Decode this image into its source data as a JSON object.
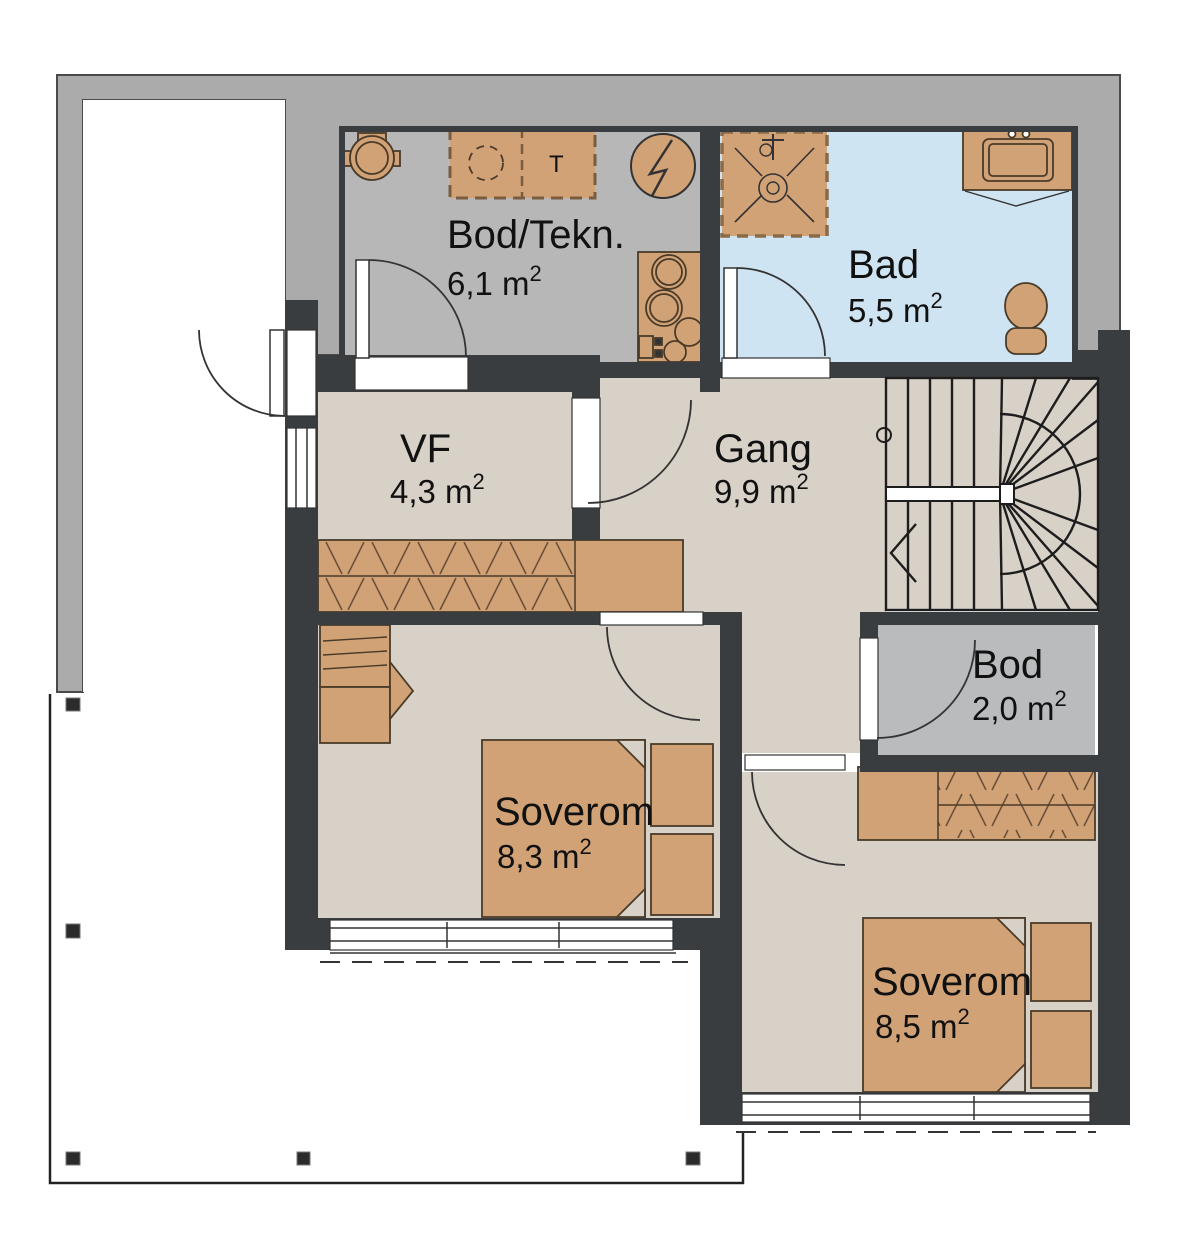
{
  "plan": {
    "sup": "2",
    "rooms": [
      {
        "id": "bodtekn",
        "name": "Bod/Tekn.",
        "area": "6,1 m"
      },
      {
        "id": "bad",
        "name": "Bad",
        "area": "5,5 m"
      },
      {
        "id": "vf",
        "name": "VF",
        "area": "4,3 m"
      },
      {
        "id": "gang",
        "name": "Gang",
        "area": "9,9 m"
      },
      {
        "id": "bod",
        "name": "Bod",
        "area": "2,0 m"
      },
      {
        "id": "soverom-1",
        "name": "Soverom",
        "area": "8,3 m"
      },
      {
        "id": "soverom-2",
        "name": "Soverom",
        "area": "8,5 m"
      }
    ],
    "appliance_labels": {
      "dryer": "T"
    },
    "colors": {
      "wall": "#3a3d3f",
      "exterior_zone": "#ababab",
      "floor_main": "#d8d1c8",
      "floor_tech": "#b7b7b7",
      "floor_bath": "#cfe4f2",
      "floor_storage": "#b9bbbd",
      "furniture": "#d2a277",
      "line": "#333333"
    }
  }
}
